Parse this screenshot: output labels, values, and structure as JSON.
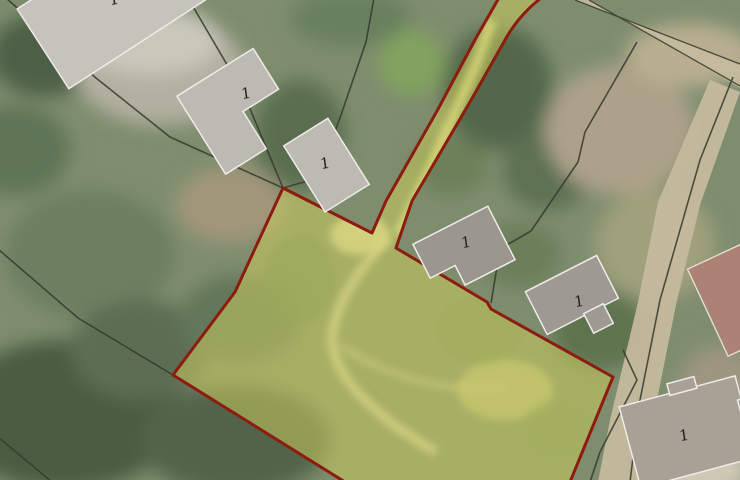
{
  "map": {
    "colors": {
      "parcel_highlight": "#cdd05e",
      "parcel_boundary": "#8e1b10",
      "cadastral_line": "#343a2d",
      "road_fill": "#c7bb9e",
      "building_fill": "#bdb9b3",
      "building_outline": "#edece7"
    },
    "buildings": [
      {
        "label": "1"
      },
      {
        "label": "1"
      },
      {
        "label": "1"
      },
      {
        "label": "1"
      },
      {
        "label": "1"
      },
      {
        "label": "1"
      }
    ]
  }
}
